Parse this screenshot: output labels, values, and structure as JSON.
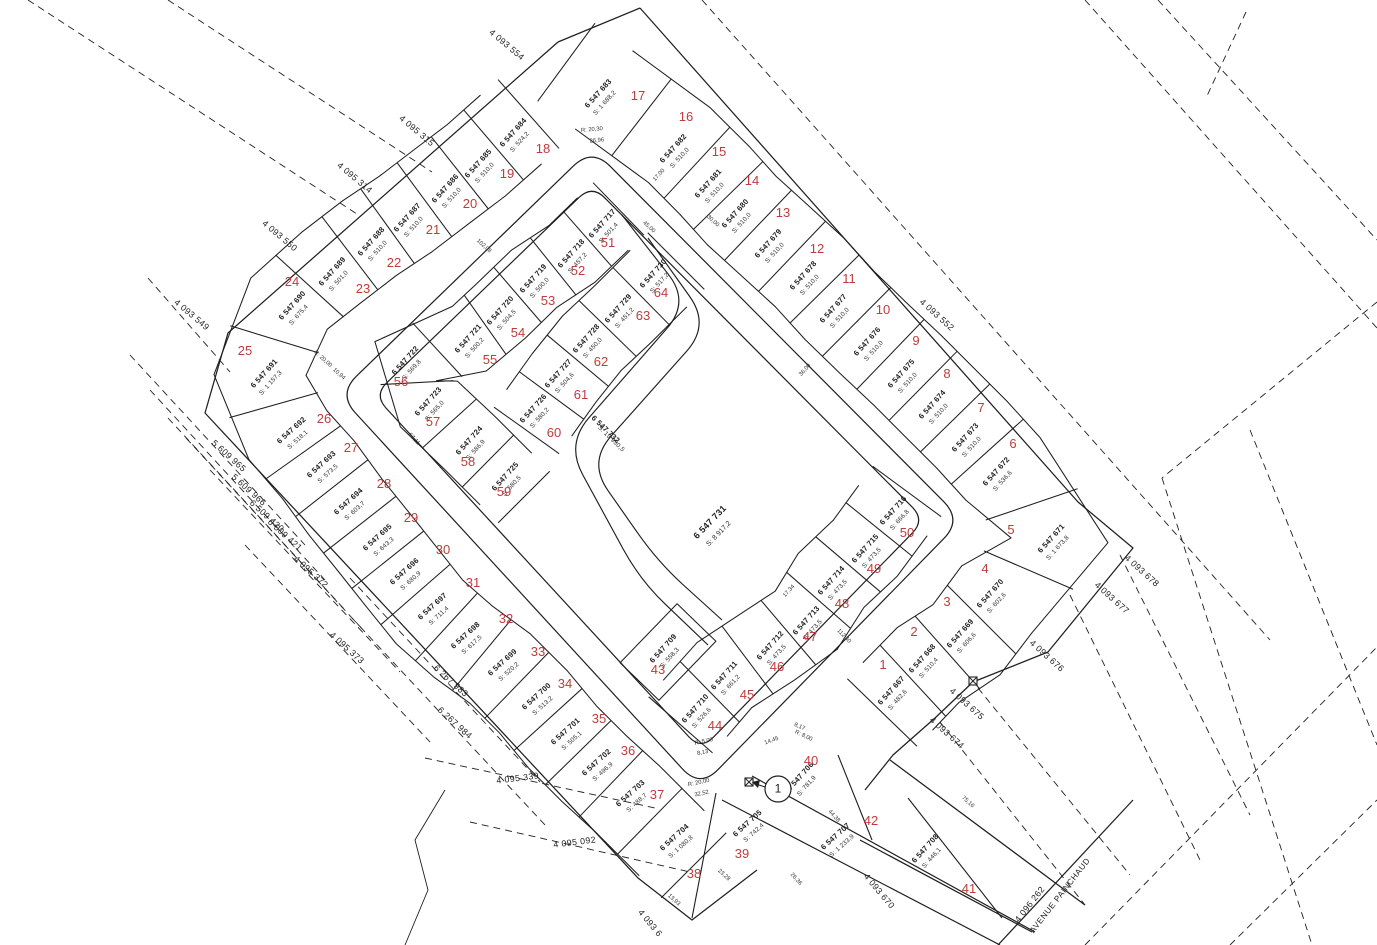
{
  "map": {
    "title": "Plan cadastral - lotissement",
    "colors": {
      "line": "#1f1f1f",
      "lot_number_red": "#bf3c3c",
      "background": "#ffffff"
    },
    "street": {
      "name": "AVENUE PAINCHAUD",
      "x": 1062,
      "y": 897,
      "rot": -52
    },
    "center_parcel": {
      "id": "6 547 731",
      "area": "S: 8 917,2",
      "x": 712,
      "y": 524,
      "rot": -46
    },
    "road_parcel": {
      "id": "6 547 732",
      "area": "S: 13 930,5",
      "x": 604,
      "y": 431,
      "rot": 44
    },
    "detail_callout": {
      "label": "1",
      "x": 778,
      "y": 789
    },
    "lots": [
      {
        "n": "1",
        "id": "6 547 667",
        "area": "S: 482,6",
        "x": 893,
        "y": 692,
        "nx": 883,
        "ny": 669,
        "rot": -48
      },
      {
        "n": "2",
        "id": "6 547 668",
        "area": "S: 510,4",
        "x": 924,
        "y": 660,
        "nx": 914,
        "ny": 636,
        "rot": -48
      },
      {
        "n": "3",
        "id": "6 547 669",
        "area": "S: 606,6",
        "x": 962,
        "y": 635,
        "nx": 947,
        "ny": 606,
        "rot": -48
      },
      {
        "n": "4",
        "id": "6 547 670",
        "area": "S: 602,6",
        "x": 992,
        "y": 595,
        "nx": 985,
        "ny": 573,
        "rot": -48
      },
      {
        "n": "5",
        "id": "6 547 671",
        "area": "S: 1 673,8",
        "x": 1053,
        "y": 540,
        "nx": 1011,
        "ny": 534,
        "rot": -48
      },
      {
        "n": "6",
        "id": "6 547 672",
        "area": "S: 536,6",
        "x": 998,
        "y": 473,
        "nx": 1013,
        "ny": 448,
        "rot": -48
      },
      {
        "n": "7",
        "id": "6 547 673",
        "area": "S: 510,0",
        "x": 967,
        "y": 439,
        "nx": 981,
        "ny": 412,
        "rot": -48
      },
      {
        "n": "8",
        "id": "6 547 674",
        "area": "S: 510,0",
        "x": 934,
        "y": 406,
        "nx": 947,
        "ny": 378,
        "rot": -48
      },
      {
        "n": "9",
        "id": "6 547 675",
        "area": "S: 510,0",
        "x": 903,
        "y": 375,
        "nx": 916,
        "ny": 345,
        "rot": -48
      },
      {
        "n": "10",
        "id": "6 547 676",
        "area": "S: 510,0",
        "x": 869,
        "y": 343,
        "nx": 883,
        "ny": 314,
        "rot": -48
      },
      {
        "n": "11",
        "id": "6 547 677",
        "area": "S: 510,0",
        "x": 835,
        "y": 310,
        "nx": 849,
        "ny": 283,
        "rot": -48
      },
      {
        "n": "12",
        "id": "6 547 678",
        "area": "S: 510,0",
        "x": 805,
        "y": 277,
        "nx": 817,
        "ny": 253,
        "rot": -48
      },
      {
        "n": "13",
        "id": "6 547 679",
        "area": "S: 510,0",
        "x": 770,
        "y": 245,
        "nx": 783,
        "ny": 217,
        "rot": -48
      },
      {
        "n": "14",
        "id": "6 547 680",
        "area": "S: 510,0",
        "x": 737,
        "y": 215,
        "nx": 752,
        "ny": 185,
        "rot": -48
      },
      {
        "n": "15",
        "id": "6 547 681",
        "area": "S: 510,0",
        "x": 710,
        "y": 185,
        "nx": 719,
        "ny": 156,
        "rot": -48
      },
      {
        "n": "16",
        "id": "6 547 682",
        "area": "S: 510,0",
        "x": 675,
        "y": 150,
        "nx": 686,
        "ny": 121,
        "rot": -48
      },
      {
        "n": "17",
        "id": "6 547 683",
        "area": "S: 1 688,2",
        "x": 600,
        "y": 95,
        "nx": 638,
        "ny": 100,
        "rot": -48
      },
      {
        "n": "18",
        "id": "6 547 684",
        "area": "S: 524,2",
        "x": 515,
        "y": 134,
        "nx": 543,
        "ny": 153,
        "rot": -48
      },
      {
        "n": "19",
        "id": "6 547 685",
        "area": "S: 510,0",
        "x": 480,
        "y": 165,
        "nx": 507,
        "ny": 178,
        "rot": -48
      },
      {
        "n": "20",
        "id": "6 547 686",
        "area": "S: 510,0",
        "x": 447,
        "y": 190,
        "nx": 470,
        "ny": 208,
        "rot": -48
      },
      {
        "n": "21",
        "id": "6 547 687",
        "area": "S: 510,0",
        "x": 409,
        "y": 219,
        "nx": 433,
        "ny": 234,
        "rot": -48
      },
      {
        "n": "22",
        "id": "6 547 688",
        "area": "S: 510,0",
        "x": 373,
        "y": 243,
        "nx": 394,
        "ny": 267,
        "rot": -48
      },
      {
        "n": "23",
        "id": "6 547 689",
        "area": "S: 501,0",
        "x": 334,
        "y": 273,
        "nx": 363,
        "ny": 293,
        "rot": -48
      },
      {
        "n": "24",
        "id": "6 547 690",
        "area": "S: 675,4",
        "x": 294,
        "y": 307,
        "nx": 292,
        "ny": 286,
        "rot": -48
      },
      {
        "n": "25",
        "id": "6 547 691",
        "area": "S: 1 157,3",
        "x": 266,
        "y": 375,
        "nx": 245,
        "ny": 355,
        "rot": -48
      },
      {
        "n": "26",
        "id": "6 547 692",
        "area": "S: 518,1",
        "x": 293,
        "y": 432,
        "nx": 324,
        "ny": 423,
        "rot": -42
      },
      {
        "n": "27",
        "id": "6 547 693",
        "area": "S: 573,5",
        "x": 323,
        "y": 466,
        "nx": 351,
        "ny": 452,
        "rot": -42
      },
      {
        "n": "28",
        "id": "6 547 694",
        "area": "S: 603,7",
        "x": 350,
        "y": 503,
        "nx": 384,
        "ny": 488,
        "rot": -42
      },
      {
        "n": "29",
        "id": "6 547 695",
        "area": "S: 643,3",
        "x": 379,
        "y": 539,
        "nx": 411,
        "ny": 522,
        "rot": -42
      },
      {
        "n": "30",
        "id": "6 547 696",
        "area": "S: 680,9",
        "x": 406,
        "y": 573,
        "nx": 443,
        "ny": 554,
        "rot": -42
      },
      {
        "n": "31",
        "id": "6 547 697",
        "area": "S: 711,4",
        "x": 434,
        "y": 608,
        "nx": 473,
        "ny": 587,
        "rot": -42
      },
      {
        "n": "32",
        "id": "6 547 698",
        "area": "S: 617,5",
        "x": 467,
        "y": 637,
        "nx": 506,
        "ny": 623,
        "rot": -42
      },
      {
        "n": "33",
        "id": "6 547 699",
        "area": "S: 520,2",
        "x": 504,
        "y": 664,
        "nx": 538,
        "ny": 656,
        "rot": -42
      },
      {
        "n": "34",
        "id": "6 547 700",
        "area": "S: 513,2",
        "x": 538,
        "y": 698,
        "nx": 565,
        "ny": 688,
        "rot": -42
      },
      {
        "n": "35",
        "id": "6 547 701",
        "area": "S: 505,1",
        "x": 567,
        "y": 733,
        "nx": 599,
        "ny": 723,
        "rot": -42
      },
      {
        "n": "36",
        "id": "6 547 702",
        "area": "S: 496,9",
        "x": 598,
        "y": 764,
        "nx": 628,
        "ny": 755,
        "rot": -42
      },
      {
        "n": "37",
        "id": "6 547 703",
        "area": "S: 488,7",
        "x": 632,
        "y": 795,
        "nx": 657,
        "ny": 799,
        "rot": -42
      },
      {
        "n": "38",
        "id": "6 547 704",
        "area": "S: 1 080,8",
        "x": 676,
        "y": 839,
        "nx": 694,
        "ny": 878,
        "rot": -42
      },
      {
        "n": "39",
        "id": "6 547 705",
        "area": "S: 742,4",
        "x": 749,
        "y": 825,
        "nx": 742,
        "ny": 858,
        "rot": -42
      },
      {
        "n": "40",
        "id": "6 547 706",
        "area": "S: 781,9",
        "x": 802,
        "y": 778,
        "nx": 811,
        "ny": 765,
        "rot": -48
      },
      {
        "n": "41",
        "id": "6 547 708",
        "area": "S: 446,1",
        "x": 927,
        "y": 850,
        "nx": 969,
        "ny": 893,
        "rot": -48
      },
      {
        "n": "42",
        "id": "6 547 707",
        "area": "S: 1 233,9",
        "x": 837,
        "y": 838,
        "nx": 871,
        "ny": 825,
        "rot": -42
      },
      {
        "n": "43",
        "id": "6 547 709",
        "area": "S: 558,3",
        "x": 665,
        "y": 650,
        "nx": 658,
        "ny": 674,
        "rot": -48
      },
      {
        "n": "44",
        "id": "6 547 710",
        "area": "S: 526,6",
        "x": 697,
        "y": 710,
        "nx": 715,
        "ny": 730,
        "rot": -48
      },
      {
        "n": "45",
        "id": "6 547 711",
        "area": "S: 661,2",
        "x": 726,
        "y": 677,
        "nx": 747,
        "ny": 699,
        "rot": -48
      },
      {
        "n": "46",
        "id": "6 547 712",
        "area": "S: 473,5",
        "x": 772,
        "y": 647,
        "nx": 777,
        "ny": 671,
        "rot": -48
      },
      {
        "n": "47",
        "id": "6 547 713",
        "area": "S: 473,5",
        "x": 808,
        "y": 622,
        "nx": 810,
        "ny": 641,
        "rot": -48
      },
      {
        "n": "48",
        "id": "6 547 714",
        "area": "S: 473,5",
        "x": 833,
        "y": 582,
        "nx": 842,
        "ny": 608,
        "rot": -48
      },
      {
        "n": "49",
        "id": "6 547 715",
        "area": "S: 473,5",
        "x": 867,
        "y": 550,
        "nx": 874,
        "ny": 573,
        "rot": -48
      },
      {
        "n": "50",
        "id": "6 547 716",
        "area": "S: 666,8",
        "x": 895,
        "y": 512,
        "nx": 907,
        "ny": 537,
        "rot": -48
      },
      {
        "n": "51",
        "id": "6 547 717",
        "area": "S: 501,4",
        "x": 604,
        "y": 225,
        "nx": 608,
        "ny": 247,
        "rot": -48
      },
      {
        "n": "52",
        "id": "6 547 718",
        "area": "S: 457,2",
        "x": 573,
        "y": 255,
        "nx": 578,
        "ny": 275,
        "rot": -48
      },
      {
        "n": "53",
        "id": "6 547 719",
        "area": "S: 500,0",
        "x": 535,
        "y": 280,
        "nx": 548,
        "ny": 305,
        "rot": -48
      },
      {
        "n": "54",
        "id": "6 547 720",
        "area": "S: 504,5",
        "x": 502,
        "y": 312,
        "nx": 518,
        "ny": 337,
        "rot": -48
      },
      {
        "n": "55",
        "id": "6 547 721",
        "area": "S: 500,2",
        "x": 470,
        "y": 340,
        "nx": 490,
        "ny": 364,
        "rot": -48
      },
      {
        "n": "56",
        "id": "6 547 722",
        "area": "S: 569,8",
        "x": 407,
        "y": 362,
        "nx": 401,
        "ny": 386,
        "rot": -48
      },
      {
        "n": "57",
        "id": "6 547 723",
        "area": "S: 565,0",
        "x": 430,
        "y": 403,
        "nx": 433,
        "ny": 426,
        "rot": -48
      },
      {
        "n": "58",
        "id": "6 547 724",
        "area": "S: 586,9",
        "x": 471,
        "y": 442,
        "nx": 468,
        "ny": 466,
        "rot": -48
      },
      {
        "n": "59",
        "id": "6 547 725",
        "area": "S: 580,5",
        "x": 507,
        "y": 478,
        "nx": 504,
        "ny": 496,
        "rot": -48
      },
      {
        "n": "60",
        "id": "6 547 726",
        "area": "S: 580,2",
        "x": 535,
        "y": 410,
        "nx": 554,
        "ny": 437,
        "rot": -48
      },
      {
        "n": "61",
        "id": "6 547 727",
        "area": "S: 504,6",
        "x": 560,
        "y": 375,
        "nx": 581,
        "ny": 399,
        "rot": -48
      },
      {
        "n": "62",
        "id": "6 547 728",
        "area": "S: 450,0",
        "x": 588,
        "y": 340,
        "nx": 601,
        "ny": 366,
        "rot": -48
      },
      {
        "n": "63",
        "id": "6 547 729",
        "area": "S: 451,2",
        "x": 620,
        "y": 310,
        "nx": 643,
        "ny": 320,
        "rot": -48
      },
      {
        "n": "64",
        "id": "6 547 730",
        "area": "S: 517,2",
        "x": 655,
        "y": 275,
        "nx": 661,
        "ny": 297,
        "rot": -48
      }
    ],
    "adjacent_parcels": [
      {
        "label": "4 093 554",
        "x": 505,
        "y": 47,
        "rot": 40
      },
      {
        "label": "4 095 315",
        "x": 415,
        "y": 133,
        "rot": 40
      },
      {
        "label": "4 095 314",
        "x": 353,
        "y": 180,
        "rot": 40
      },
      {
        "label": "4 093 550",
        "x": 278,
        "y": 238,
        "rot": 40
      },
      {
        "label": "4 093 549",
        "x": 190,
        "y": 317,
        "rot": 40
      },
      {
        "label": "4 093 552",
        "x": 935,
        "y": 317,
        "rot": 42
      },
      {
        "label": "5 609 965",
        "x": 227,
        "y": 458,
        "rot": 42
      },
      {
        "label": "5 609 966",
        "x": 247,
        "y": 492,
        "rot": 42
      },
      {
        "label": "6 509 420",
        "x": 265,
        "y": 518,
        "rot": 42
      },
      {
        "label": "6 509 421",
        "x": 283,
        "y": 537,
        "rot": 42
      },
      {
        "label": "4 095 372",
        "x": 309,
        "y": 574,
        "rot": 42
      },
      {
        "label": "4 095 373",
        "x": 345,
        "y": 650,
        "rot": 42
      },
      {
        "label": "6 267 983",
        "x": 449,
        "y": 683,
        "rot": 42
      },
      {
        "label": "6 267 984",
        "x": 453,
        "y": 725,
        "rot": 42
      },
      {
        "label": "4 095 339",
        "x": 518,
        "y": 781,
        "rot": -7
      },
      {
        "label": "4 095 092",
        "x": 575,
        "y": 845,
        "rot": -7
      },
      {
        "label": "4 093 670",
        "x": 877,
        "y": 893,
        "rot": 50
      },
      {
        "label": "4 093 674",
        "x": 945,
        "y": 735,
        "rot": 42
      },
      {
        "label": "4 093 675",
        "x": 965,
        "y": 706,
        "rot": 42
      },
      {
        "label": "4 093 676",
        "x": 1045,
        "y": 658,
        "rot": 42
      },
      {
        "label": "4 093 677",
        "x": 1110,
        "y": 600,
        "rot": 42
      },
      {
        "label": "4 093 678",
        "x": 1140,
        "y": 573,
        "rot": 42
      },
      {
        "label": "4 096 262",
        "x": 1032,
        "y": 906,
        "rot": -52
      },
      {
        "label": "4 093 6",
        "x": 648,
        "y": 925,
        "rot": 50
      }
    ],
    "annotations": [
      {
        "t": "R: 20,30",
        "x": 592,
        "y": 131,
        "r": -5
      },
      {
        "t": "26,96",
        "x": 597,
        "y": 142,
        "r": -5
      },
      {
        "t": "R: 20,00",
        "x": 699,
        "y": 784,
        "r": -12
      },
      {
        "t": "32,52",
        "x": 702,
        "y": 795,
        "r": -12
      },
      {
        "t": "R: 5,00",
        "x": 704,
        "y": 743,
        "r": -12
      },
      {
        "t": "8,13",
        "x": 703,
        "y": 754,
        "r": -12
      },
      {
        "t": "R: 8,00",
        "x": 803,
        "y": 737,
        "r": 25
      },
      {
        "t": "8,17",
        "x": 799,
        "y": 728,
        "r": 25
      },
      {
        "t": "R: 20,00",
        "x": 322,
        "y": 360,
        "r": 42
      },
      {
        "t": "10,94",
        "x": 338,
        "y": 375,
        "r": 42
      },
      {
        "t": "102,08",
        "x": 483,
        "y": 247,
        "r": 42
      },
      {
        "t": "67,11",
        "x": 413,
        "y": 440,
        "r": 46
      },
      {
        "t": "112,40",
        "x": 843,
        "y": 637,
        "r": 46
      },
      {
        "t": "44,38",
        "x": 833,
        "y": 817,
        "r": 48
      },
      {
        "t": "75,16",
        "x": 967,
        "y": 803,
        "r": 42
      },
      {
        "t": "45,00",
        "x": 648,
        "y": 228,
        "r": 42
      },
      {
        "t": "30,00",
        "x": 712,
        "y": 222,
        "r": 42
      },
      {
        "t": "17,00",
        "x": 660,
        "y": 176,
        "r": -48
      },
      {
        "t": "36,00",
        "x": 806,
        "y": 371,
        "r": -48
      },
      {
        "t": "17,34",
        "x": 790,
        "y": 592,
        "r": -48
      },
      {
        "t": "23,28",
        "x": 723,
        "y": 876,
        "r": 42
      },
      {
        "t": "26,36",
        "x": 795,
        "y": 880,
        "r": 48
      },
      {
        "t": "14,45",
        "x": 772,
        "y": 742,
        "r": -20
      },
      {
        "t": "13,93",
        "x": 673,
        "y": 901,
        "r": 42
      }
    ]
  }
}
